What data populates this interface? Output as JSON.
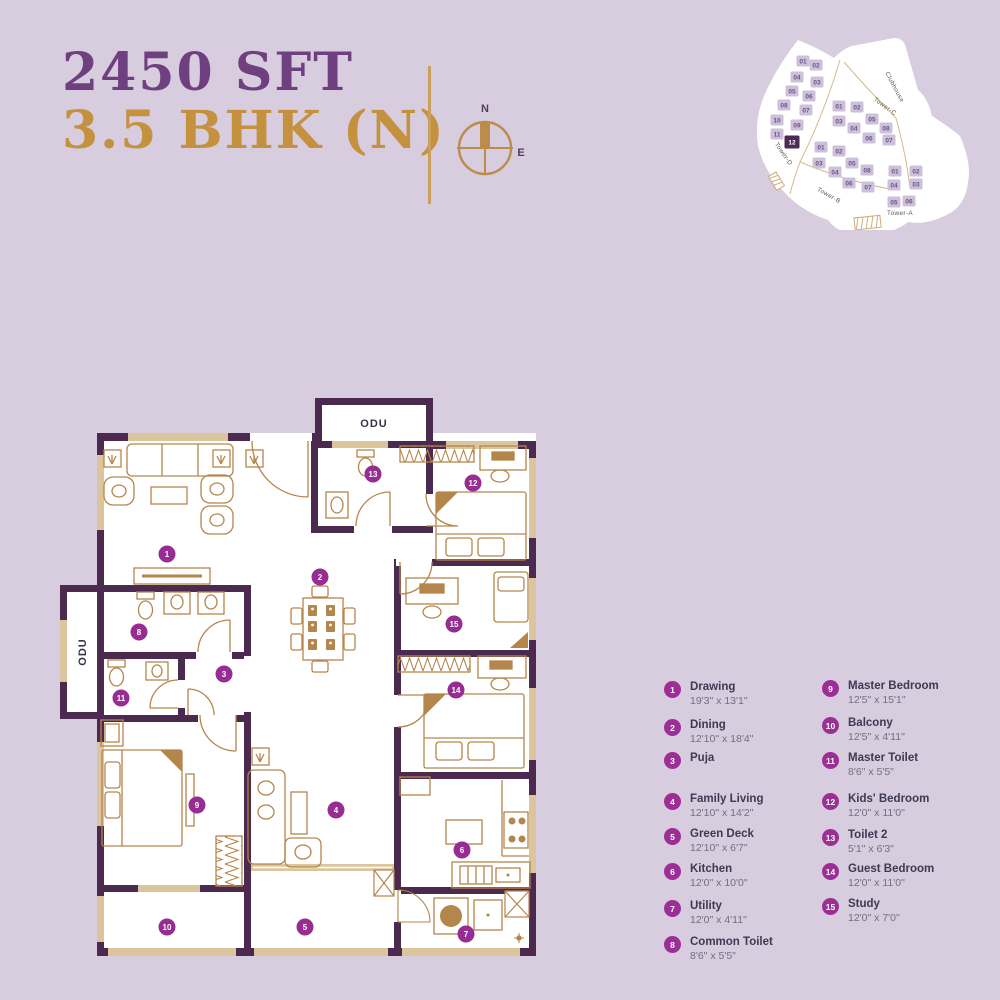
{
  "header": {
    "area": "2450 SFT",
    "type": "3.5 BHK (N)"
  },
  "compass": {
    "north": "N",
    "east": "E"
  },
  "colors": {
    "background": "#d8ccdf",
    "wall": "#4c294e",
    "wood": "#b5864c",
    "window": "#dcc49c",
    "marker": "#972d92",
    "title_purple": "#6f4080",
    "title_gold": "#c4913f",
    "site_unit_fill": "#cdc0da",
    "site_unit_text": "#6b5488",
    "site_highlight": "#4b2a55"
  },
  "floor_plan": {
    "odu_top": "ODU",
    "odu_left": "ODU",
    "markers": [
      {
        "num": "1",
        "x": 167,
        "y": 554
      },
      {
        "num": "2",
        "x": 320,
        "y": 577
      },
      {
        "num": "3",
        "x": 224,
        "y": 674
      },
      {
        "num": "4",
        "x": 336,
        "y": 810
      },
      {
        "num": "5",
        "x": 305,
        "y": 927
      },
      {
        "num": "6",
        "x": 462,
        "y": 850
      },
      {
        "num": "7",
        "x": 466,
        "y": 934
      },
      {
        "num": "8",
        "x": 139,
        "y": 632
      },
      {
        "num": "9",
        "x": 197,
        "y": 805
      },
      {
        "num": "10",
        "x": 167,
        "y": 927
      },
      {
        "num": "11",
        "x": 121,
        "y": 698
      },
      {
        "num": "12",
        "x": 473,
        "y": 483
      },
      {
        "num": "13",
        "x": 373,
        "y": 474
      },
      {
        "num": "14",
        "x": 456,
        "y": 690
      },
      {
        "num": "15",
        "x": 454,
        "y": 624
      }
    ]
  },
  "site_map": {
    "highlighted_unit": "12",
    "clubhouse_label": "Clubhouse",
    "labels": [
      {
        "text": "Clubhouse",
        "x": 145,
        "y": 64,
        "rot": 62
      },
      {
        "text": "Tower-C",
        "x": 136,
        "y": 84,
        "rot": 36
      },
      {
        "text": "Tower-D",
        "x": 34,
        "y": 131,
        "rot": 55
      },
      {
        "text": "Tower-B",
        "x": 80,
        "y": 173,
        "rot": 30
      },
      {
        "text": "Tower-A",
        "x": 152,
        "y": 191,
        "rot": 0
      }
    ],
    "units": [
      {
        "label": "01",
        "x": 55,
        "y": 37
      },
      {
        "label": "02",
        "x": 68,
        "y": 41
      },
      {
        "label": "04",
        "x": 49,
        "y": 53
      },
      {
        "label": "03",
        "x": 69,
        "y": 58
      },
      {
        "label": "05",
        "x": 44,
        "y": 67
      },
      {
        "label": "06",
        "x": 61,
        "y": 72
      },
      {
        "label": "08",
        "x": 36,
        "y": 81
      },
      {
        "label": "07",
        "x": 58,
        "y": 86
      },
      {
        "label": "10",
        "x": 29,
        "y": 96
      },
      {
        "label": "09",
        "x": 49,
        "y": 101
      },
      {
        "label": "11",
        "x": 29,
        "y": 110
      },
      {
        "label": "12",
        "x": 44,
        "y": 118,
        "hl": true
      },
      {
        "label": "01",
        "x": 91,
        "y": 82
      },
      {
        "label": "02",
        "x": 109,
        "y": 83
      },
      {
        "label": "03",
        "x": 91,
        "y": 97
      },
      {
        "label": "04",
        "x": 106,
        "y": 104
      },
      {
        "label": "05",
        "x": 124,
        "y": 95
      },
      {
        "label": "06",
        "x": 121,
        "y": 114
      },
      {
        "label": "08",
        "x": 138,
        "y": 104
      },
      {
        "label": "07",
        "x": 141,
        "y": 116
      },
      {
        "label": "01",
        "x": 73,
        "y": 123
      },
      {
        "label": "02",
        "x": 91,
        "y": 127
      },
      {
        "label": "03",
        "x": 71,
        "y": 139
      },
      {
        "label": "04",
        "x": 87,
        "y": 148
      },
      {
        "label": "05",
        "x": 104,
        "y": 139
      },
      {
        "label": "08",
        "x": 119,
        "y": 146
      },
      {
        "label": "06",
        "x": 101,
        "y": 159
      },
      {
        "label": "07",
        "x": 120,
        "y": 163
      },
      {
        "label": "01",
        "x": 147,
        "y": 147
      },
      {
        "label": "02",
        "x": 168,
        "y": 147
      },
      {
        "label": "04",
        "x": 146,
        "y": 161
      },
      {
        "label": "03",
        "x": 168,
        "y": 160
      },
      {
        "label": "05",
        "x": 146,
        "y": 178
      },
      {
        "label": "06",
        "x": 161,
        "y": 177
      }
    ]
  },
  "legend": {
    "items": [
      {
        "num": "1",
        "name": "Drawing",
        "dims": "19'3\" x 13'1\""
      },
      {
        "num": "2",
        "name": "Dining",
        "dims": "12'10\" x 18'4\""
      },
      {
        "num": "3",
        "name": "Puja",
        "dims": ""
      },
      {
        "num": "4",
        "name": "Family Living",
        "dims": "12'10\" x 14'2\""
      },
      {
        "num": "5",
        "name": "Green Deck",
        "dims": "12'10\" x 6'7\""
      },
      {
        "num": "6",
        "name": "Kitchen",
        "dims": "12'0\" x 10'0\""
      },
      {
        "num": "7",
        "name": "Utility",
        "dims": "12'0\" x 4'11\""
      },
      {
        "num": "8",
        "name": "Common Toilet",
        "dims": "8'6\" x 5'5\""
      },
      {
        "num": "9",
        "name": "Master Bedroom",
        "dims": "12'5\" x 15'1\""
      },
      {
        "num": "10",
        "name": "Balcony",
        "dims": "12'5\" x 4'11\""
      },
      {
        "num": "11",
        "name": "Master Toilet",
        "dims": "8'6\" x 5'5\""
      },
      {
        "num": "12",
        "name": "Kids' Bedroom",
        "dims": "12'0\" x 11'0\""
      },
      {
        "num": "13",
        "name": "Toilet 2",
        "dims": "5'1\" x 6'3\""
      },
      {
        "num": "14",
        "name": "Guest Bedroom",
        "dims": "12'0\" x 11'0\""
      },
      {
        "num": "15",
        "name": "Study",
        "dims": "12'0\" x 7'0\""
      }
    ]
  }
}
